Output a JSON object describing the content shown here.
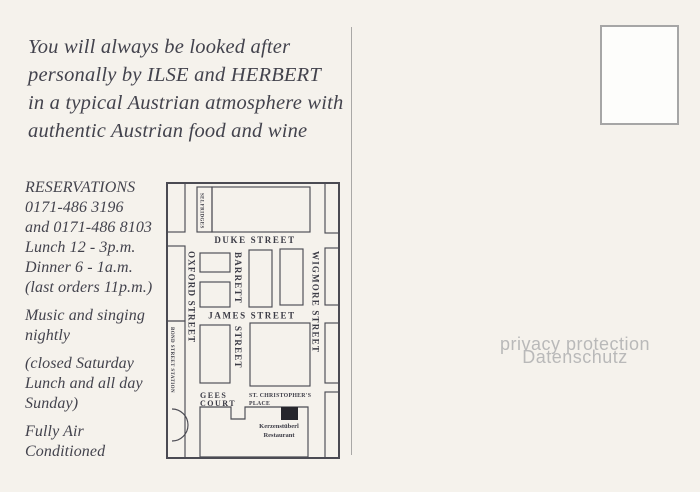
{
  "intro": {
    "lines": [
      "You will always be looked after",
      "personally by ILSE and HERBERT",
      "in a typical Austrian atmosphere with",
      "authentic Austrian food and wine"
    ]
  },
  "details": {
    "reservations": [
      "RESERVATIONS",
      "0171-486 3196",
      "and 0171-486 8103",
      "Lunch 12 - 3p.m.",
      "Dinner 6 - 1a.m.",
      "(last orders 11p.m.)"
    ],
    "music": [
      "Music and singing",
      "nightly"
    ],
    "closed": [
      "(closed Saturday",
      "Lunch and all day",
      "Sunday)"
    ],
    "aircon": [
      "Fully Air",
      "Conditioned"
    ]
  },
  "map": {
    "streets": {
      "duke": "DUKE STREET",
      "james": "JAMES STREET",
      "oxford": "OXFORD STREET",
      "wigmore": "WIGMORE STREET",
      "barrett": "BARRETT",
      "barrett_cont": "STREET"
    },
    "places": {
      "selfridges": "SELFRIDGES",
      "bond_station": "BOND STREET STATION",
      "gees_1": "GEES",
      "gees_2": "COURT",
      "stchris_1": "ST. CHRISTOPHER'S",
      "stchris_2": "PLACE",
      "restaurant_1": "Kerzenstüberl",
      "restaurant_2": "Restaurant"
    }
  },
  "watermark": {
    "line1": "privacy protection",
    "line2": "Datenschutz"
  },
  "colors": {
    "background": "#f5f2ec",
    "ink": "#43434d",
    "map_line": "#4b4b53",
    "marker": "#26262c",
    "watermark": "#b9b9b9"
  }
}
